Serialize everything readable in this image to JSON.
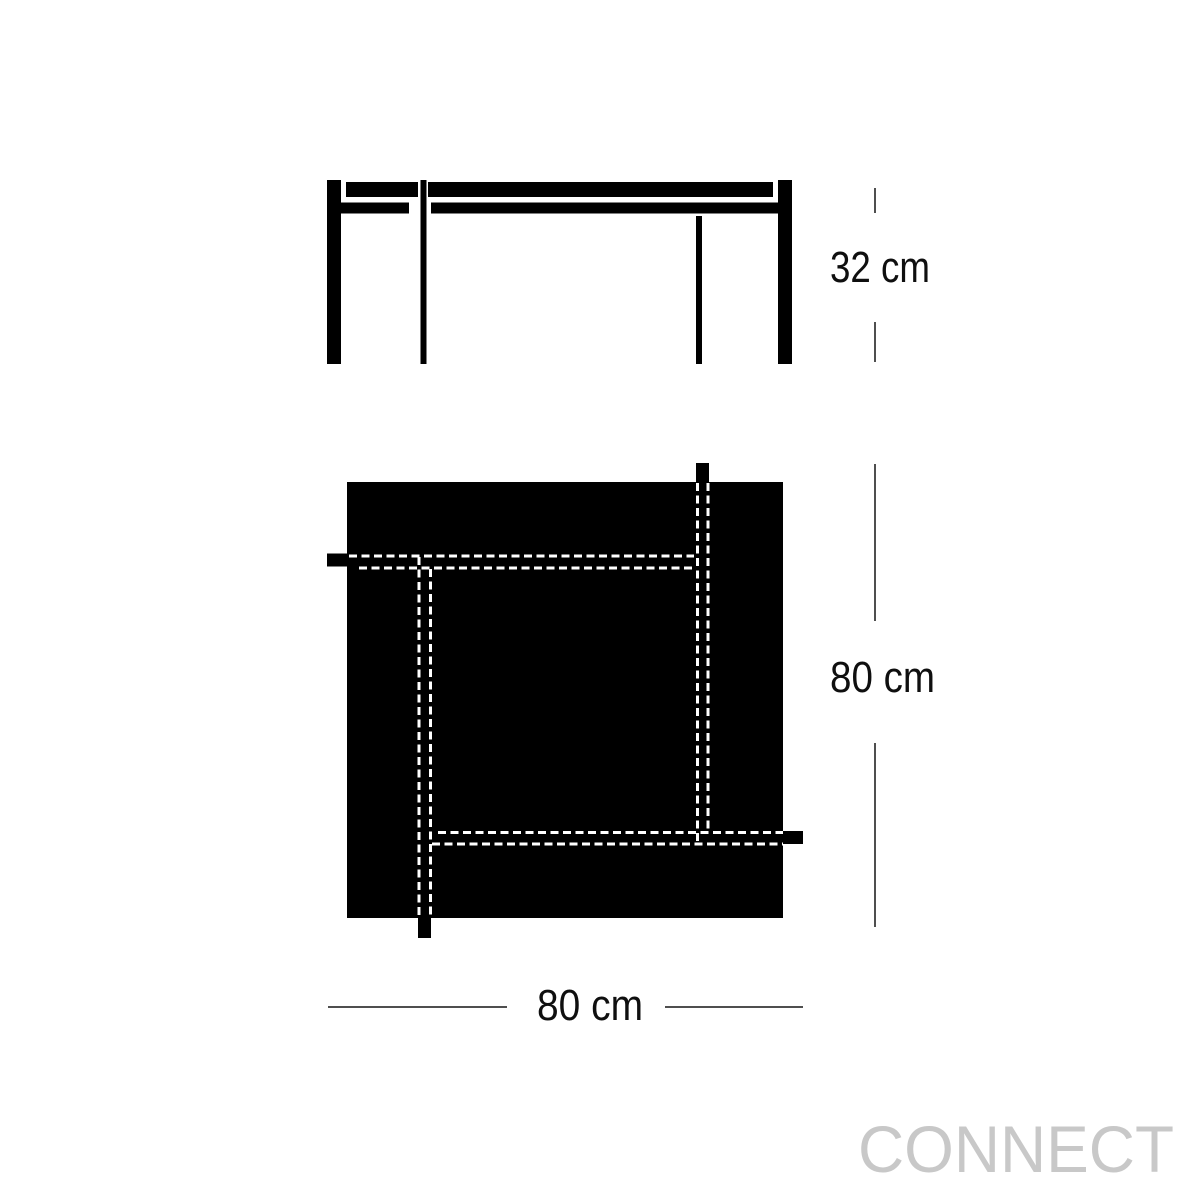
{
  "labels": {
    "height": "32 cm",
    "depth": "80 cm",
    "width": "80 cm"
  },
  "watermark": "CONNECT",
  "colors": {
    "drawing": "#000000",
    "dimension_lines": "#4f4f4f",
    "label_text": "#0f0f0f",
    "apron_dashes": "#ffffff",
    "watermark": "#c8c8c8",
    "background": "#ffffff"
  }
}
